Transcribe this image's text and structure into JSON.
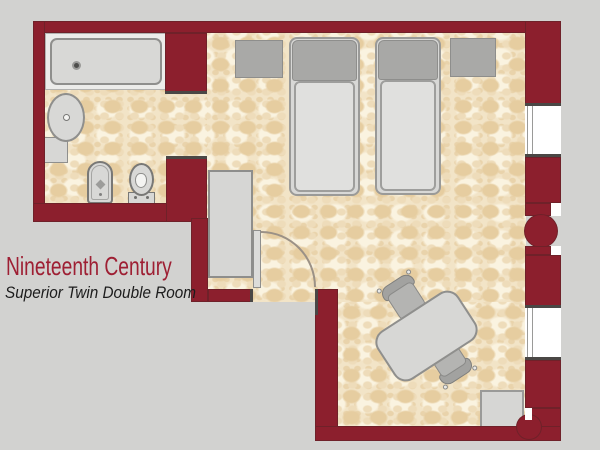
{
  "plan": {
    "title": "Nineteenth Century",
    "subtitle": "Superior Twin Double Room",
    "colors": {
      "bg": "#d2d2d0",
      "wall": "#8c1f2d",
      "floor": "#f2e4c7",
      "fixture": "#d8d8d6",
      "fixtureDark": "#a9a9a7",
      "window": "#ffffff",
      "titleColor": "#9e1f33",
      "subtitleColor": "#1c1c1c"
    },
    "rooms": [
      {
        "name": "bathroom",
        "fixtures": [
          "bathtub",
          "washbasin",
          "vanity counter",
          "bidet",
          "toilet"
        ]
      },
      {
        "name": "bedroom",
        "fixtures": [
          "twin bed",
          "twin bed",
          "nightstand",
          "nightstand",
          "wardrobe",
          "table",
          "chair",
          "chair",
          "luggage rack",
          "door",
          "window",
          "window",
          "column detail",
          "column detail"
        ]
      }
    ]
  }
}
